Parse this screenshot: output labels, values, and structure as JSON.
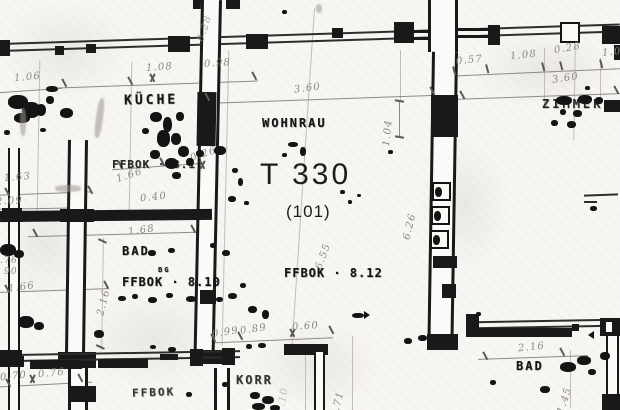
{
  "plan": {
    "unit_label": "T 330",
    "unit_number": "(101)",
    "rooms": {
      "kitchen": "KÜCHE",
      "living_room": "WOHNRAU",
      "bedroom": "ZIMMER",
      "bath_left": "BAD",
      "bath_right": "BAD",
      "corridor": "KORR"
    },
    "floor_levels": {
      "living_room": "FFBOK · 8.12",
      "kitchen": "FFBOK · 8.1",
      "bath_left": "FFBOK · 8.10",
      "bath_left_note": "BG",
      "corridor_area": "FFBOK"
    },
    "dimensions": [
      "1.06",
      "1.08",
      "0.98",
      "3.60",
      "0.57",
      "1.08",
      "0.28",
      "1.0",
      "3.60",
      "0.28",
      "1.04",
      "1.63",
      "1.66",
      "0.26",
      "2.09",
      "0.40",
      "1.68",
      "2.16",
      "1.66",
      ".76",
      "90",
      "6.55",
      "6.26",
      "0.99",
      "0.89",
      "0.60",
      "0.70",
      "0.76",
      "2.16",
      "1.45",
      "1.71",
      "1.10"
    ],
    "colors": {
      "ink": "#141414",
      "pencil": "#8b8880",
      "paper": "#f7f6f2"
    }
  }
}
